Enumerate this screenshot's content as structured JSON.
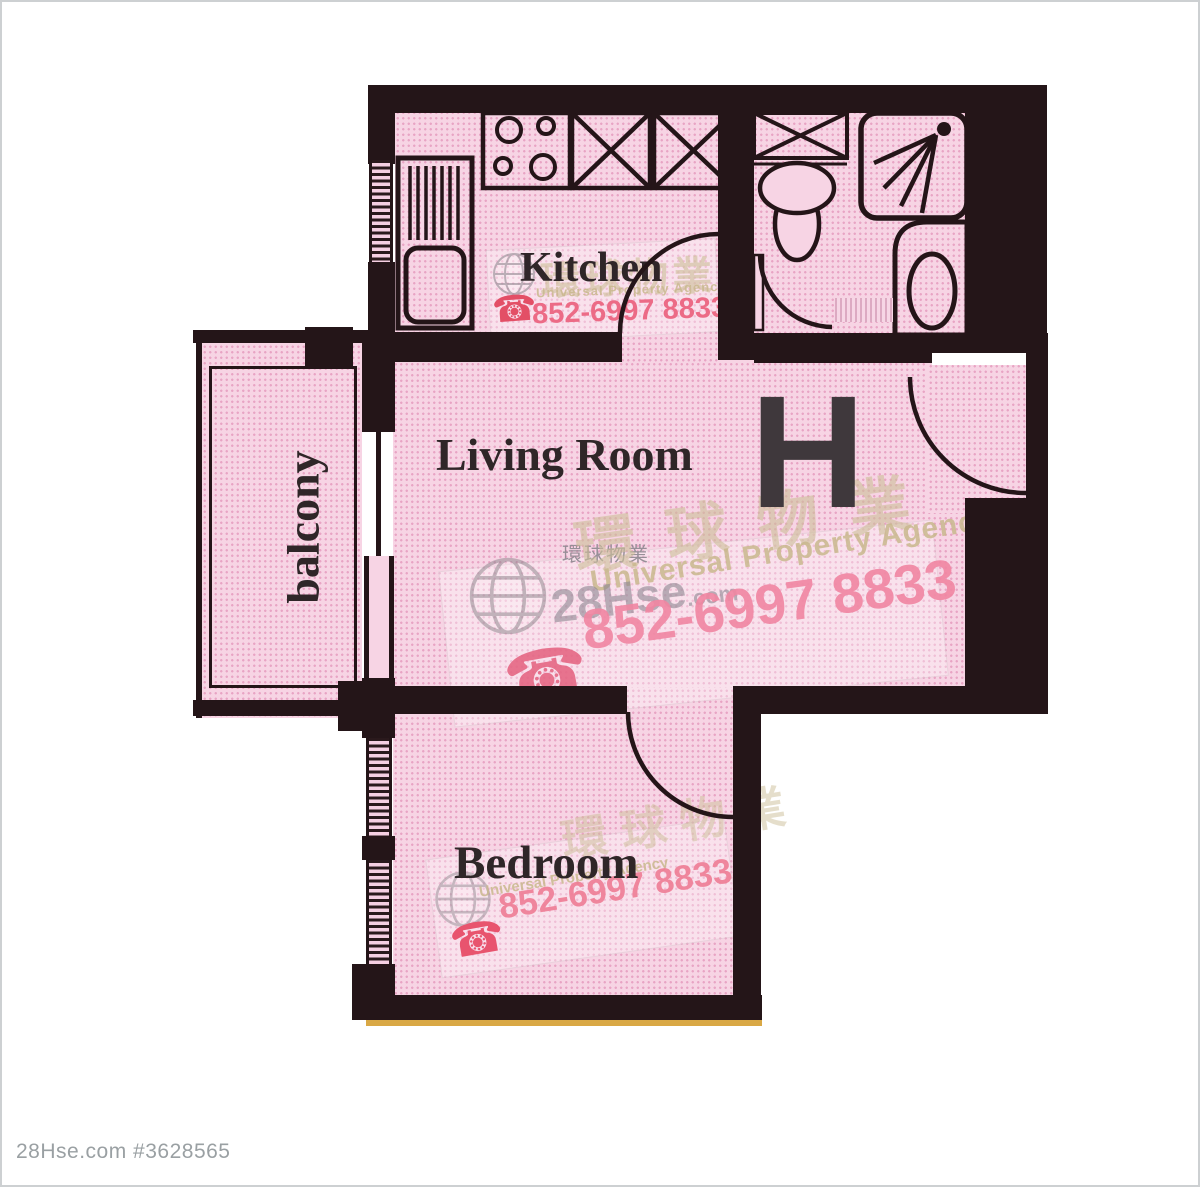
{
  "rooms": {
    "kitchen": "Kitchen",
    "living_room": "Living Room",
    "bedroom": "Bedroom",
    "balcony": "balcony",
    "unit": "H"
  },
  "watermark": {
    "phone": "852-6997 8833",
    "agency_en": "Universal Property Agency",
    "agency_zh": "環球物業",
    "brand": "28Hse",
    "brand_suffix": ".com"
  },
  "icons": {
    "phone": "☎"
  },
  "footer": {
    "text": "28Hse.com #3628565"
  },
  "colors": {
    "wall": "#241518",
    "floor_pink": "#f7d4e4",
    "floor_dot": "#e8a4c4",
    "label_dark": "#2f2628",
    "unit_gray": "#3f383c",
    "watermark_pink": "#f186a2",
    "watermark_red": "#e95f7d",
    "watermark_beige": "#cdbf98",
    "watermark_gray": "#8d8691",
    "footer_gray": "#9aa0a3",
    "threshold_yellow": "#d9a845"
  }
}
